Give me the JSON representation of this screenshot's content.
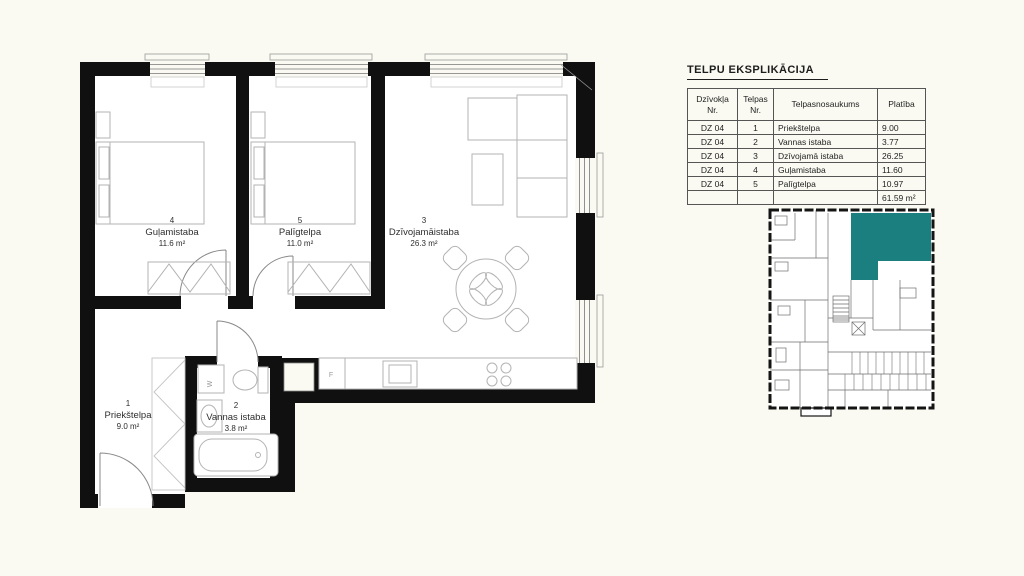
{
  "page": {
    "background_color": "#fafaf2",
    "accent_teal": "#1b7f7f"
  },
  "explication": {
    "title": "TELPU EKSPLIKĀCIJA",
    "columns": {
      "apartment": "Dzīvokļa Nr.",
      "room": "Telpas Nr.",
      "name": "Telpasnosaukums",
      "area": "Platība"
    },
    "rows": [
      {
        "apartment": "DZ 04",
        "room": "1",
        "name": "Priekštelpa",
        "area": "9.00"
      },
      {
        "apartment": "DZ 04",
        "room": "2",
        "name": "Vannas istaba",
        "area": "3.77"
      },
      {
        "apartment": "DZ 04",
        "room": "3",
        "name": "Dzīvojamā istaba",
        "area": "26.25"
      },
      {
        "apartment": "DZ 04",
        "room": "4",
        "name": "Guļamistaba",
        "area": "11.60"
      },
      {
        "apartment": "DZ 04",
        "room": "5",
        "name": "Palīgtelpa",
        "area": "10.97"
      }
    ],
    "total_area": "61.59 m²"
  },
  "floor_plan": {
    "rooms": {
      "hall": {
        "number": "1",
        "name": "Priekštelpa",
        "area": "9.0 m²"
      },
      "bathroom": {
        "number": "2",
        "name": "Vannas istaba",
        "area": "3.8 m²"
      },
      "living": {
        "number": "3",
        "name": "Dzīvojamāistaba",
        "area": "26.3 m²"
      },
      "bedroom": {
        "number": "4",
        "name": "Guļamistaba",
        "area": "11.6 m²"
      },
      "utility": {
        "number": "5",
        "name": "Palīgtelpa",
        "area": "11.0 m²"
      }
    },
    "labels": {
      "fridge": "F",
      "washer": "W"
    }
  },
  "mini_plan": {
    "highlight_color": "#1b7f7f"
  }
}
